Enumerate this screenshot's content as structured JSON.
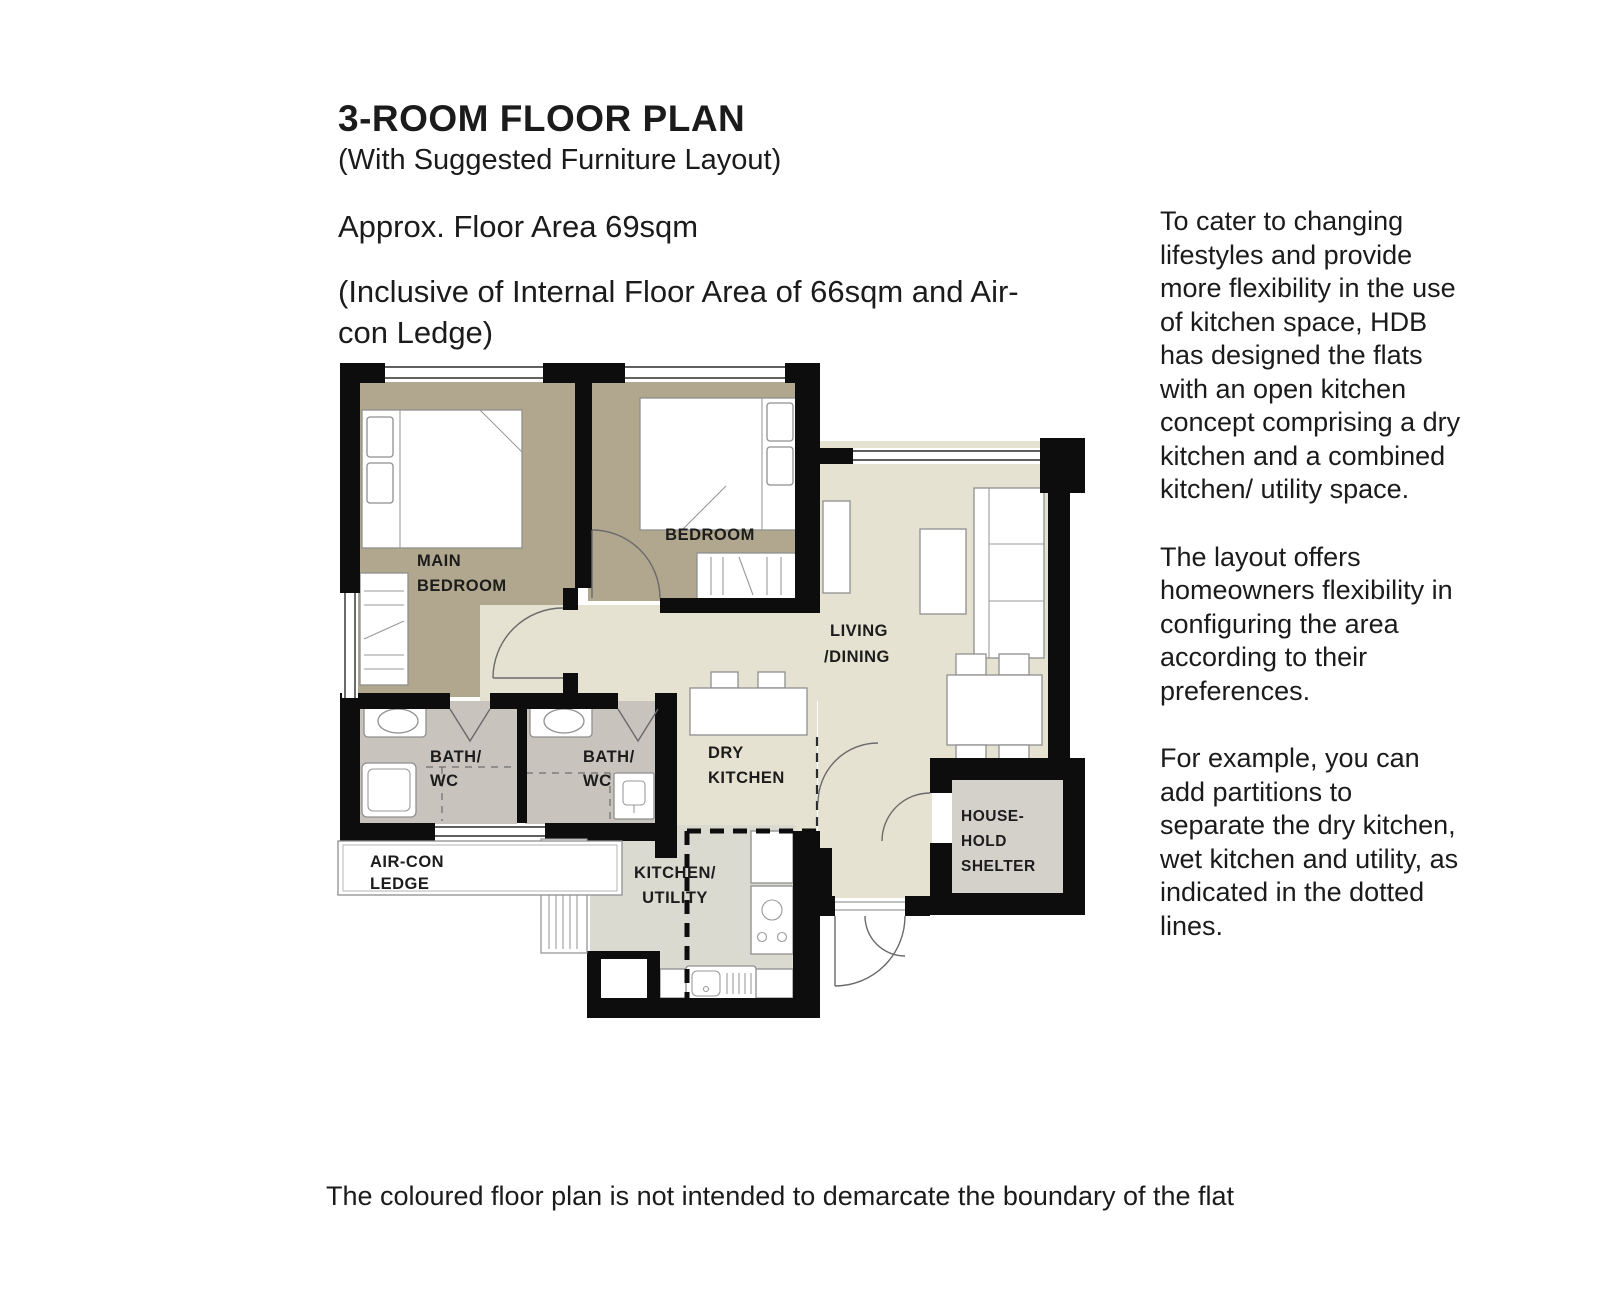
{
  "header": {
    "title": "3-ROOM FLOOR PLAN",
    "subtitle": "(With Suggested Furniture Layout)",
    "area_line": "Approx. Floor Area 69sqm",
    "inclusive_line": "(Inclusive of Internal Floor Area of 66sqm and Air-con Ledge)"
  },
  "sidebar": {
    "paragraphs": [
      "To cater to changing lifestyles and provide more flexibility in the use of kitchen space, HDB has designed the flats with an open kitchen concept comprising a dry kitchen and a combined kitchen/ utility space.",
      "The layout offers homeowners flexibility in configuring the area according to their preferences.",
      "For example, you can add partitions to separate the dry kitchen, wet kitchen and utility, as indicated in the dotted lines."
    ]
  },
  "floorplan": {
    "rooms": {
      "main_bedroom": [
        "MAIN",
        "BEDROOM"
      ],
      "bedroom": [
        "BEDROOM"
      ],
      "living_dining": [
        "LIVING",
        "/DINING"
      ],
      "bath1": [
        "BATH/",
        "WC"
      ],
      "bath2": [
        "BATH/",
        "WC"
      ],
      "dry_kitchen": [
        "DRY",
        "KITCHEN"
      ],
      "aircon_ledge": [
        "AIR-CON",
        "LEDGE"
      ],
      "kitchen_utility": [
        "KITCHEN/",
        "UTILITY"
      ],
      "household_shelter": [
        "HOUSE-",
        "HOLD",
        "SHELTER"
      ]
    }
  },
  "footer": {
    "disclaimer": "The coloured floor plan is not intended to demarcate the boundary of the flat"
  },
  "colors": {
    "bedroom_floor": "#b1a78f",
    "living_floor": "#e6e2d1",
    "bath_floor": "#c8c3bc",
    "kitchen_floor": "#dbdad1",
    "shelter_floor": "#d4d1cb",
    "wall": "#0d0d0d"
  }
}
